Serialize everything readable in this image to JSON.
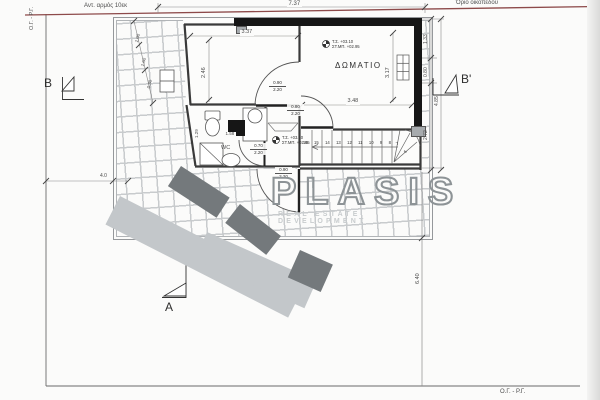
{
  "labels": {
    "joint": "Αντ. αρμός 10εκ",
    "plot_boundary": "Όριο οικοπέδου",
    "building_line_left": "Ο.Γ. - Ρ.Γ.",
    "building_line_bottom": "Ο.Γ. - Ρ.Γ.",
    "room": "ΔΩΜΑΤΙΟ",
    "wc": "WC"
  },
  "section_markers": {
    "b": "B",
    "b_prime": "B'",
    "a": "A"
  },
  "levels": {
    "room_marker": {
      "line1": "Τ.Σ. +03.10",
      "line2": "ΣΤ.ΜΠ. +02.95"
    },
    "stair_marker": {
      "line1": "Τ.Σ. +03.10",
      "line2": "ΣΤ.ΜΠ. +02.95"
    }
  },
  "dimensions": {
    "top_total": "7.37",
    "left_room_width": "3.37",
    "left_room_depth": "2.46",
    "bedroom_width": "3.48",
    "bedroom_depth": "3.17",
    "bath_width": "1.58",
    "bath_depth": "1.29",
    "right_seg1": "1.33",
    "right_seg2": "0.80",
    "right_seg3": "2.72",
    "right_total": "4.85",
    "right_lower": "6.40",
    "left_offset": "4.0",
    "terrace_seg1": "1.00",
    "terrace_seg2": "1.60",
    "terrace_seg3": "0.30"
  },
  "doors": {
    "room_door": {
      "width": "0.90",
      "height": "2.20"
    },
    "hall_door": {
      "width": "0.80",
      "height": "2.20"
    },
    "wc_door": {
      "width": "0.70",
      "height": "2.20"
    },
    "exit_door": {
      "width": "0.90",
      "height": "2.20"
    }
  },
  "stair": {
    "numbers": [
      "16",
      "15",
      "14",
      "13",
      "12",
      "11",
      "10",
      "9",
      "8"
    ],
    "winder": [
      "7",
      "6"
    ]
  },
  "watermark": {
    "name": "PLASIS",
    "tagline": "REAL ESTATE DEVELOPMENT"
  },
  "colors": {
    "boundary_red": "#8d4a4a",
    "wall_black": "#161616",
    "line": "#555555",
    "watermark_dark": "#74797c",
    "watermark_light": "#c3c7ca",
    "watermark_text": "#8d9396"
  }
}
